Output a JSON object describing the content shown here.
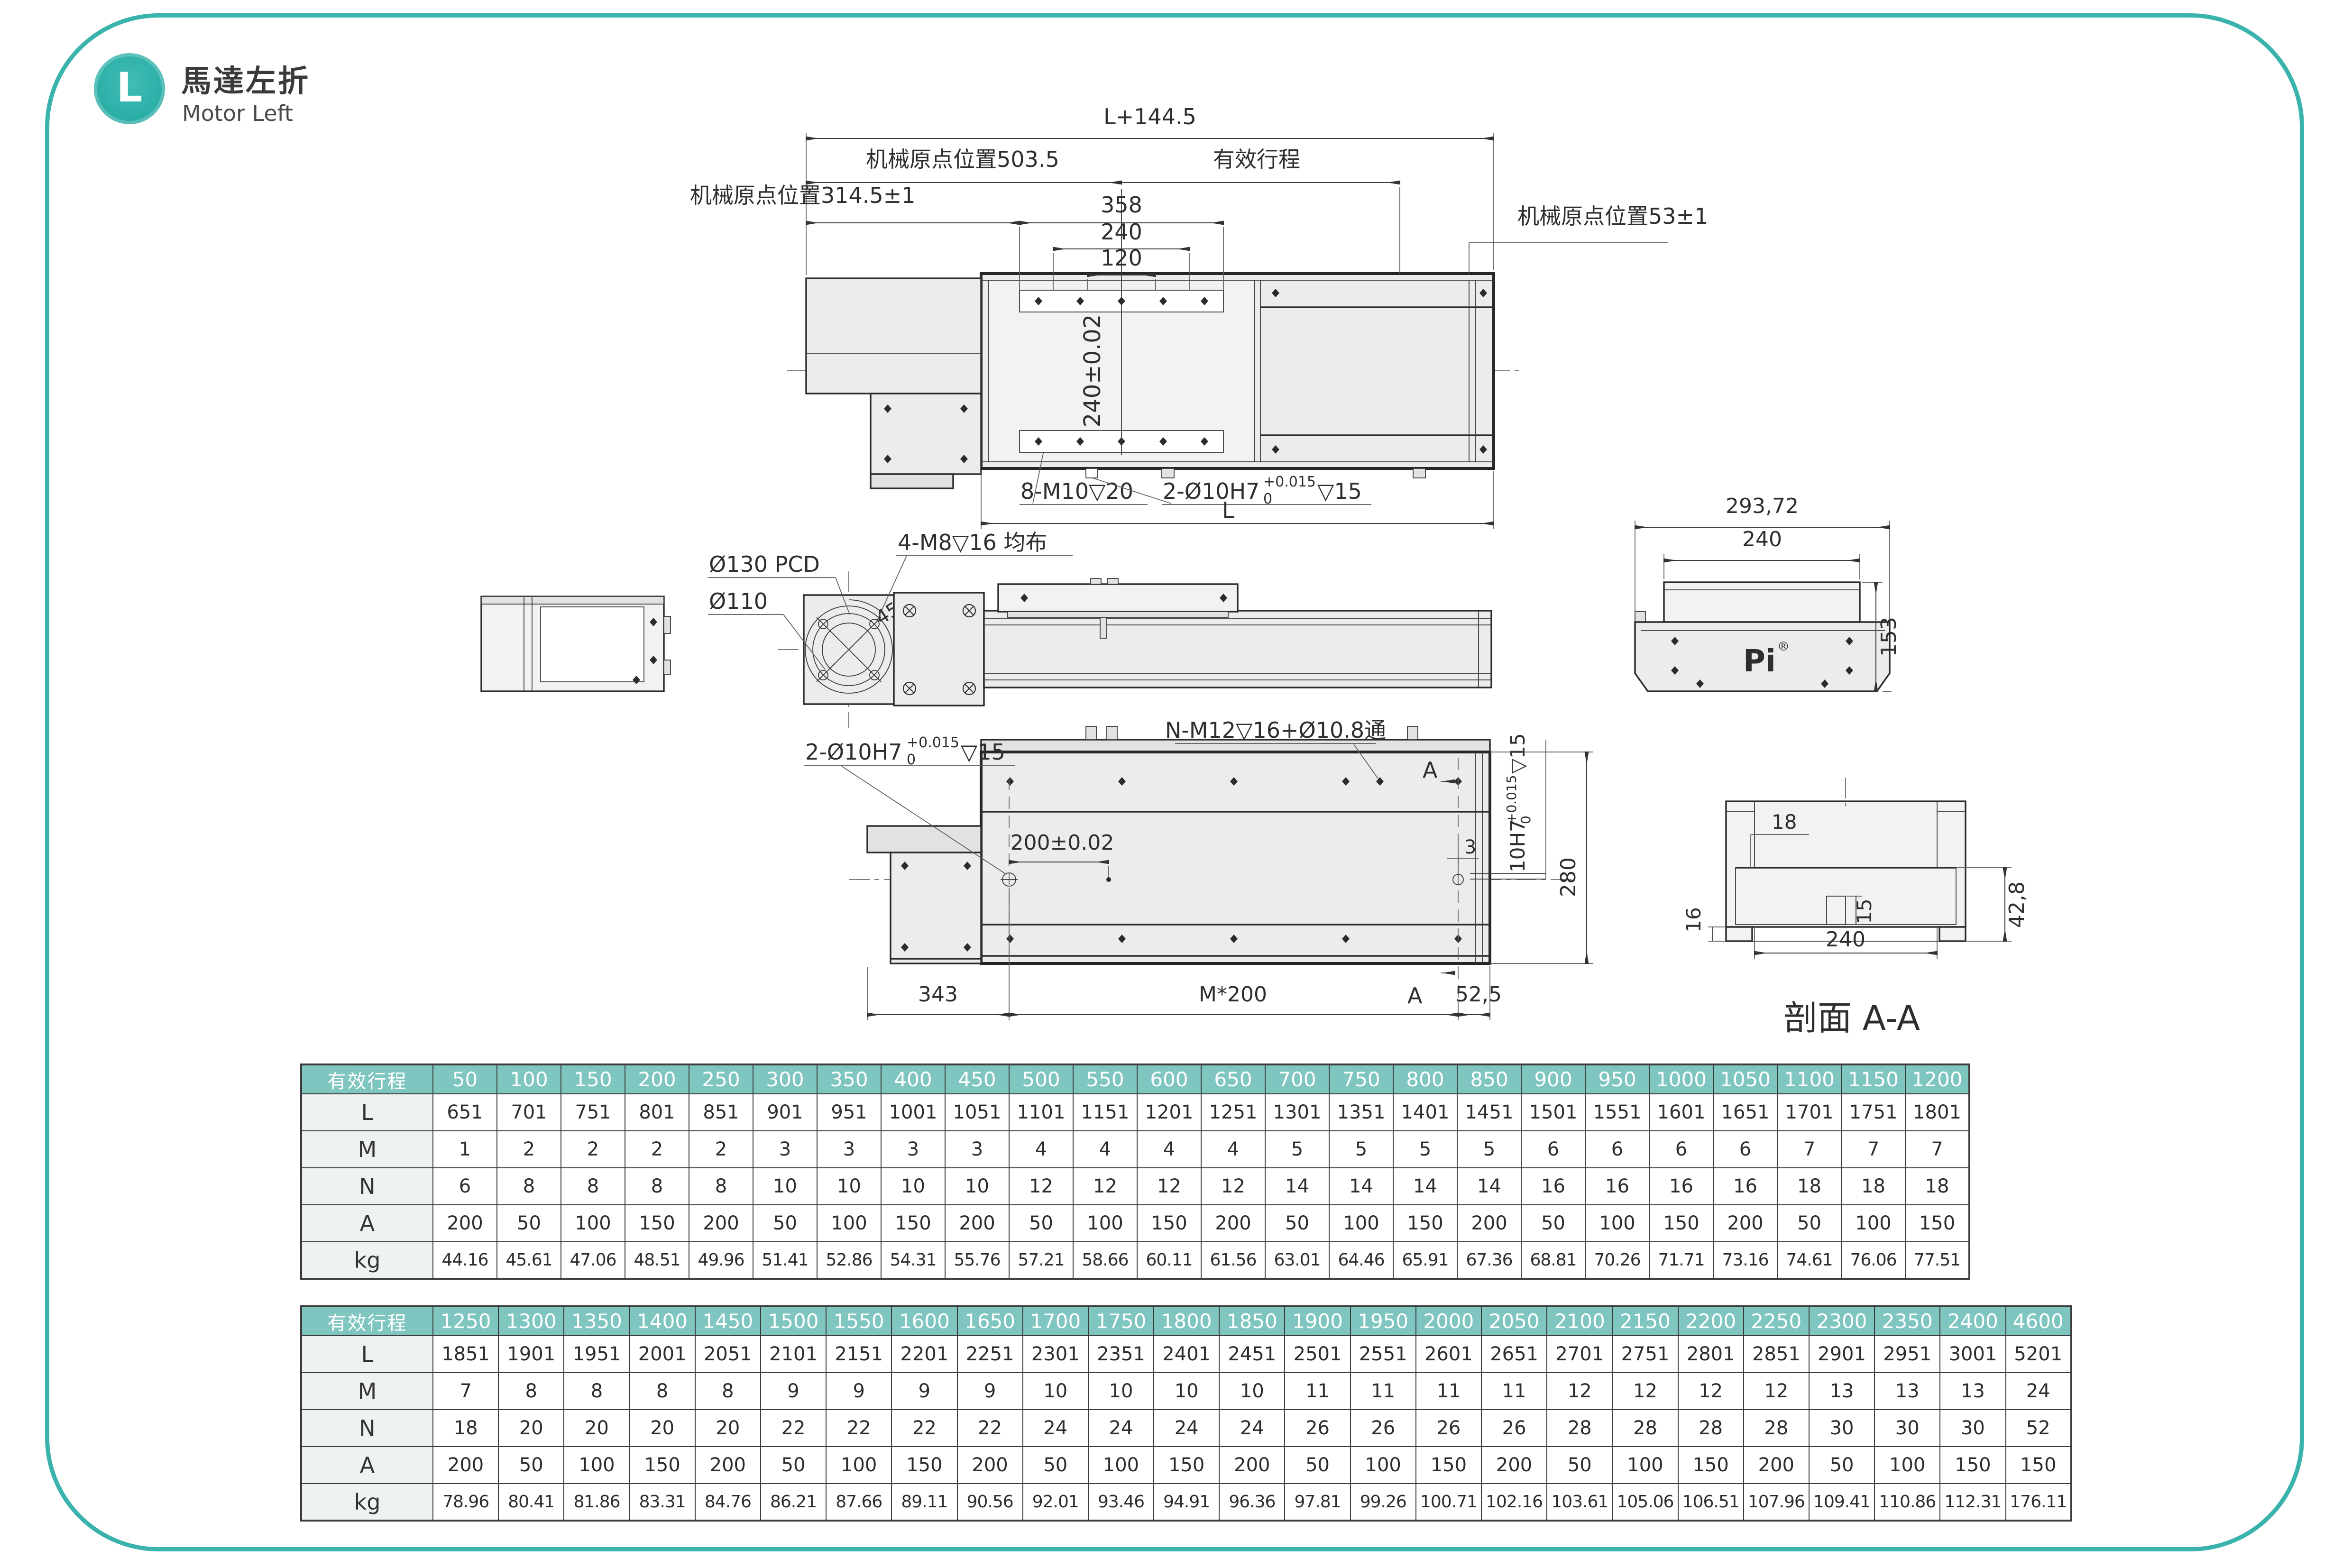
{
  "header": {
    "badge": "L",
    "title_zh": "馬達左折",
    "title_en": "Motor Left"
  },
  "colors": {
    "accent": "#3ab3ac",
    "table_header": "#7fc5c0",
    "label_bg": "#eef3f1",
    "line": "#2b2b2b"
  },
  "drawing": {
    "top_view": {
      "total_length": "L+144.5",
      "origin_503": "机械原点位置503.5",
      "stroke_label": "有效行程",
      "origin_314": "机械原点位置314.5±1",
      "dim_358": "358",
      "dim_240": "240",
      "dim_120": "120",
      "origin_53": "机械原点位置53±1",
      "table_width_tol": "240±0.02",
      "screw_note": "8-M10▽20",
      "dowel_note": {
        "prefix": "2-Ø10H7",
        "sup": "+0.015",
        "sub": "0",
        "suffix": "▽15"
      },
      "length_label": "L"
    },
    "side_view": {
      "pcd": "Ø130 PCD",
      "d110": "Ø110",
      "m8_note": "4-M8▽16 均布",
      "angle": "45°"
    },
    "end_view": {
      "width": "293,72",
      "inner_width": "240",
      "height": "153",
      "logo": "Pi",
      "logo_reg": "®"
    },
    "bottom_view": {
      "dowel_note": {
        "prefix": "2-Ø10H7",
        "sup": "+0.015",
        "sub": "0",
        "suffix": "▽15"
      },
      "nm12_note": "N-M12▽16+Ø10.8通",
      "dim_200": "200±0.02",
      "dim_3": "3",
      "bore_note": {
        "prefix": "10H7",
        "sup": "+0.015",
        "sub": "0",
        "suffix": "▽15"
      },
      "dim_280": "280",
      "dim_343": "343",
      "dim_m200": "M*200",
      "dim_52_5": "52,5",
      "section_a_top": "A",
      "section_a_bottom": "A"
    },
    "section_view": {
      "dim_18": "18",
      "dim_16": "16",
      "dim_240": "240",
      "dim_15": "15",
      "dim_42_8": "42,8",
      "title": "剖面 A-A"
    }
  },
  "tables": {
    "table1": {
      "header_label": "有效行程",
      "columns": [
        "50",
        "100",
        "150",
        "200",
        "250",
        "300",
        "350",
        "400",
        "450",
        "500",
        "550",
        "600",
        "650",
        "700",
        "750",
        "800",
        "850",
        "900",
        "950",
        "1000",
        "1050",
        "1100",
        "1150",
        "1200"
      ],
      "rows": [
        {
          "label": "L",
          "values": [
            "651",
            "701",
            "751",
            "801",
            "851",
            "901",
            "951",
            "1001",
            "1051",
            "1101",
            "1151",
            "1201",
            "1251",
            "1301",
            "1351",
            "1401",
            "1451",
            "1501",
            "1551",
            "1601",
            "1651",
            "1701",
            "1751",
            "1801"
          ]
        },
        {
          "label": "M",
          "values": [
            "1",
            "2",
            "2",
            "2",
            "2",
            "3",
            "3",
            "3",
            "3",
            "4",
            "4",
            "4",
            "4",
            "5",
            "5",
            "5",
            "5",
            "6",
            "6",
            "6",
            "6",
            "7",
            "7",
            "7"
          ]
        },
        {
          "label": "N",
          "values": [
            "6",
            "8",
            "8",
            "8",
            "8",
            "10",
            "10",
            "10",
            "10",
            "12",
            "12",
            "12",
            "12",
            "14",
            "14",
            "14",
            "14",
            "16",
            "16",
            "16",
            "16",
            "18",
            "18",
            "18"
          ]
        },
        {
          "label": "A",
          "values": [
            "200",
            "50",
            "100",
            "150",
            "200",
            "50",
            "100",
            "150",
            "200",
            "50",
            "100",
            "150",
            "200",
            "50",
            "100",
            "150",
            "200",
            "50",
            "100",
            "150",
            "200",
            "50",
            "100",
            "150"
          ]
        },
        {
          "label": "kg",
          "values": [
            "44.16",
            "45.61",
            "47.06",
            "48.51",
            "49.96",
            "51.41",
            "52.86",
            "54.31",
            "55.76",
            "57.21",
            "58.66",
            "60.11",
            "61.56",
            "63.01",
            "64.46",
            "65.91",
            "67.36",
            "68.81",
            "70.26",
            "71.71",
            "73.16",
            "74.61",
            "76.06",
            "77.51"
          ]
        }
      ]
    },
    "table2": {
      "header_label": "有效行程",
      "columns": [
        "1250",
        "1300",
        "1350",
        "1400",
        "1450",
        "1500",
        "1550",
        "1600",
        "1650",
        "1700",
        "1750",
        "1800",
        "1850",
        "1900",
        "1950",
        "2000",
        "2050",
        "2100",
        "2150",
        "2200",
        "2250",
        "2300",
        "2350",
        "2400",
        "4600"
      ],
      "rows": [
        {
          "label": "L",
          "values": [
            "1851",
            "1901",
            "1951",
            "2001",
            "2051",
            "2101",
            "2151",
            "2201",
            "2251",
            "2301",
            "2351",
            "2401",
            "2451",
            "2501",
            "2551",
            "2601",
            "2651",
            "2701",
            "2751",
            "2801",
            "2851",
            "2901",
            "2951",
            "3001",
            "5201"
          ]
        },
        {
          "label": "M",
          "values": [
            "7",
            "8",
            "8",
            "8",
            "8",
            "9",
            "9",
            "9",
            "9",
            "10",
            "10",
            "10",
            "10",
            "11",
            "11",
            "11",
            "11",
            "12",
            "12",
            "12",
            "12",
            "13",
            "13",
            "13",
            "24"
          ]
        },
        {
          "label": "N",
          "values": [
            "18",
            "20",
            "20",
            "20",
            "20",
            "22",
            "22",
            "22",
            "22",
            "24",
            "24",
            "24",
            "24",
            "26",
            "26",
            "26",
            "26",
            "28",
            "28",
            "28",
            "28",
            "30",
            "30",
            "30",
            "52"
          ]
        },
        {
          "label": "A",
          "values": [
            "200",
            "50",
            "100",
            "150",
            "200",
            "50",
            "100",
            "150",
            "200",
            "50",
            "100",
            "150",
            "200",
            "50",
            "100",
            "150",
            "200",
            "50",
            "100",
            "150",
            "200",
            "50",
            "100",
            "150",
            "150"
          ]
        },
        {
          "label": "kg",
          "values": [
            "78.96",
            "80.41",
            "81.86",
            "83.31",
            "84.76",
            "86.21",
            "87.66",
            "89.11",
            "90.56",
            "92.01",
            "93.46",
            "94.91",
            "96.36",
            "97.81",
            "99.26",
            "100.71",
            "102.16",
            "103.61",
            "105.06",
            "106.51",
            "107.96",
            "109.41",
            "110.86",
            "112.31",
            "176.11"
          ]
        }
      ]
    }
  }
}
